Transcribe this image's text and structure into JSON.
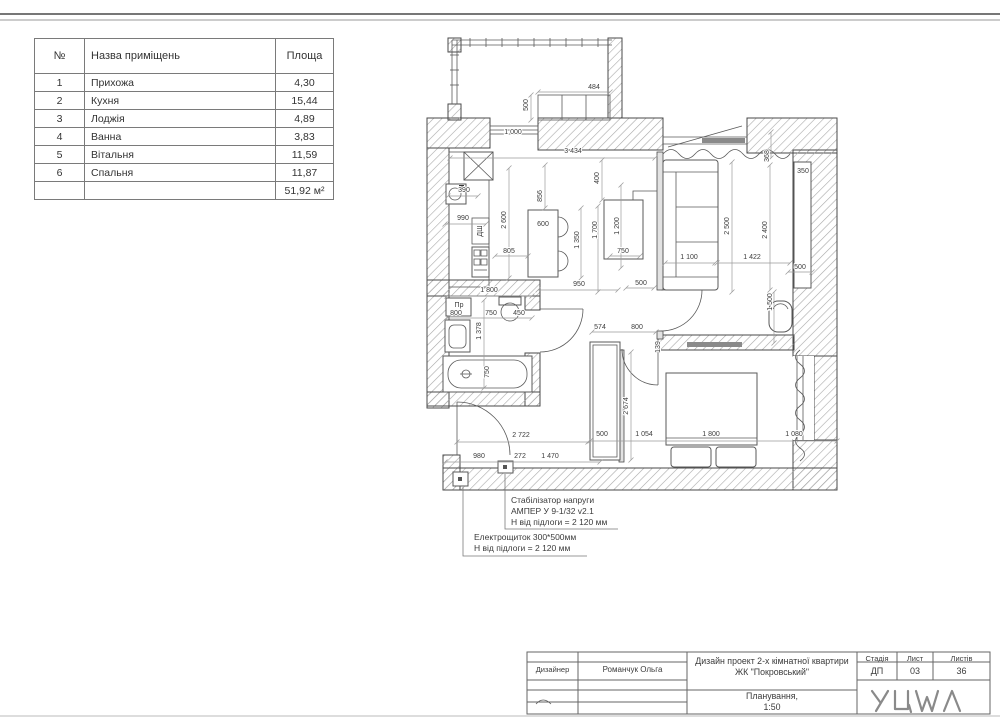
{
  "room_table": {
    "headers": {
      "num": "№",
      "name": "Назва приміщень",
      "area": "Площа"
    },
    "rows": [
      {
        "num": "1",
        "name": "Прихожа",
        "area": "4,30"
      },
      {
        "num": "2",
        "name": "Кухня",
        "area": "15,44"
      },
      {
        "num": "3",
        "name": "Лоджія",
        "area": "4,89"
      },
      {
        "num": "4",
        "name": "Ванна",
        "area": "3,83"
      },
      {
        "num": "5",
        "name": "Вітальня",
        "area": "11,59"
      },
      {
        "num": "6",
        "name": "Спальня",
        "area": "11,87"
      }
    ],
    "total": "51,92 м²"
  },
  "annotations": {
    "stabilizer": {
      "line1": "Стабілізатор напруги",
      "line2": "АМПЕР У 9-1/32 v2.1",
      "line3": "Н від підлоги = 2 120 мм"
    },
    "panel": {
      "line1": "Електрощиток 300*500мм",
      "line2": "Н від підлоги = 2 120 мм"
    }
  },
  "title_block": {
    "designer_label": "Дизайнер",
    "designer_name": "Романчук Ольга",
    "project_line1": "Дизайн проект 2-х кімнатної квартири",
    "project_line2": "ЖК \"Покровський\"",
    "stage_label": "Стадія",
    "stage_value": "ДП",
    "sheet_label": "Лист",
    "sheet_value": "03",
    "sheets_label": "Листів",
    "sheets_value": "36",
    "drawing_name_line1": "Планування,",
    "drawing_name_line2": "1:50",
    "logo_name": "YUWA logo"
  },
  "colors": {
    "line": "#4a4a4a",
    "dim_text": "#3c3c3c",
    "hatch": "#a8a8a8"
  },
  "plan": {
    "labels": [
      {
        "t": "484",
        "x": 594,
        "y": 89,
        "r": 0
      },
      {
        "t": "500",
        "x": 528,
        "y": 105,
        "r": 1
      },
      {
        "t": "1 000",
        "x": 513,
        "y": 134,
        "r": 0
      },
      {
        "t": "3 434",
        "x": 573,
        "y": 153,
        "r": 0
      },
      {
        "t": "390",
        "x": 464,
        "y": 192,
        "r": 0
      },
      {
        "t": "990",
        "x": 463,
        "y": 220,
        "r": 0
      },
      {
        "t": "ДШ",
        "x": 482,
        "y": 231,
        "r": 1
      },
      {
        "t": "805",
        "x": 509,
        "y": 253,
        "r": 0
      },
      {
        "t": "2 600",
        "x": 506,
        "y": 220,
        "r": 1
      },
      {
        "t": "856",
        "x": 542,
        "y": 196,
        "r": 1
      },
      {
        "t": "600",
        "x": 543,
        "y": 226,
        "r": 0
      },
      {
        "t": "1 350",
        "x": 579,
        "y": 240,
        "r": 1
      },
      {
        "t": "400",
        "x": 599,
        "y": 178,
        "r": 1
      },
      {
        "t": "1 700",
        "x": 597,
        "y": 230,
        "r": 1
      },
      {
        "t": "1 200",
        "x": 619,
        "y": 226,
        "r": 1
      },
      {
        "t": "750",
        "x": 623,
        "y": 253,
        "r": 0
      },
      {
        "t": "950",
        "x": 579,
        "y": 286,
        "r": 0
      },
      {
        "t": "500",
        "x": 641,
        "y": 285,
        "r": 0
      },
      {
        "t": "368",
        "x": 769,
        "y": 156,
        "r": 1
      },
      {
        "t": "350",
        "x": 803,
        "y": 173,
        "r": 0
      },
      {
        "t": "2 500",
        "x": 729,
        "y": 226,
        "r": 1
      },
      {
        "t": "2 400",
        "x": 767,
        "y": 230,
        "r": 1
      },
      {
        "t": "1 100",
        "x": 689,
        "y": 259,
        "r": 0
      },
      {
        "t": "1 422",
        "x": 752,
        "y": 259,
        "r": 0
      },
      {
        "t": "500",
        "x": 800,
        "y": 269,
        "r": 0
      },
      {
        "t": "1 500",
        "x": 772,
        "y": 302,
        "r": 1
      },
      {
        "t": "1 800",
        "x": 489,
        "y": 292,
        "r": 0
      },
      {
        "t": "Пр",
        "x": 459,
        "y": 307,
        "r": 0
      },
      {
        "t": "800",
        "x": 456,
        "y": 315,
        "r": 0
      },
      {
        "t": "750",
        "x": 491,
        "y": 315,
        "r": 0
      },
      {
        "t": "450",
        "x": 519,
        "y": 315,
        "r": 0
      },
      {
        "t": "1 378",
        "x": 481,
        "y": 331,
        "r": 1
      },
      {
        "t": "750",
        "x": 489,
        "y": 372,
        "r": 1
      },
      {
        "t": "574",
        "x": 600,
        "y": 329,
        "r": 0
      },
      {
        "t": "800",
        "x": 637,
        "y": 329,
        "r": 0
      },
      {
        "t": "139",
        "x": 660,
        "y": 347,
        "r": 1
      },
      {
        "t": "2 674",
        "x": 628,
        "y": 406,
        "r": 1
      },
      {
        "t": "500",
        "x": 602,
        "y": 436,
        "r": 0
      },
      {
        "t": "1 054",
        "x": 644,
        "y": 436,
        "r": 0
      },
      {
        "t": "1 800",
        "x": 711,
        "y": 436,
        "r": 0
      },
      {
        "t": "1 080",
        "x": 794,
        "y": 436,
        "r": 0
      },
      {
        "t": "2 722",
        "x": 521,
        "y": 437,
        "r": 0
      },
      {
        "t": "980",
        "x": 479,
        "y": 458,
        "r": 0
      },
      {
        "t": "272",
        "x": 520,
        "y": 458,
        "r": 0
      },
      {
        "t": "1 470",
        "x": 550,
        "y": 458,
        "r": 0
      }
    ],
    "dim_lines": [
      [
        450,
        158,
        655,
        158
      ],
      [
        538,
        92,
        610,
        92
      ],
      [
        531,
        95,
        531,
        120
      ],
      [
        509,
        168,
        509,
        278
      ],
      [
        545,
        165,
        545,
        208
      ],
      [
        581,
        208,
        581,
        278
      ],
      [
        602,
        160,
        602,
        200
      ],
      [
        598,
        206,
        598,
        292
      ],
      [
        621,
        185,
        621,
        268
      ],
      [
        610,
        256,
        640,
        256
      ],
      [
        538,
        290,
        618,
        290
      ],
      [
        626,
        288,
        654,
        288
      ],
      [
        732,
        162,
        732,
        292
      ],
      [
        770,
        165,
        770,
        290
      ],
      [
        665,
        263,
        715,
        263
      ],
      [
        717,
        263,
        790,
        263
      ],
      [
        771,
        132,
        771,
        158
      ],
      [
        788,
        272,
        812,
        272
      ],
      [
        774,
        292,
        774,
        343
      ],
      [
        447,
        296,
        532,
        296
      ],
      [
        447,
        318,
        532,
        318
      ],
      [
        484,
        300,
        484,
        388
      ],
      [
        592,
        332,
        656,
        332
      ],
      [
        631,
        352,
        631,
        460
      ],
      [
        590,
        441,
        837,
        441
      ],
      [
        457,
        442,
        588,
        442
      ],
      [
        445,
        462,
        600,
        462
      ],
      [
        448,
        196,
        478,
        196
      ],
      [
        445,
        224,
        486,
        224
      ],
      [
        495,
        256,
        528,
        256
      ]
    ]
  }
}
